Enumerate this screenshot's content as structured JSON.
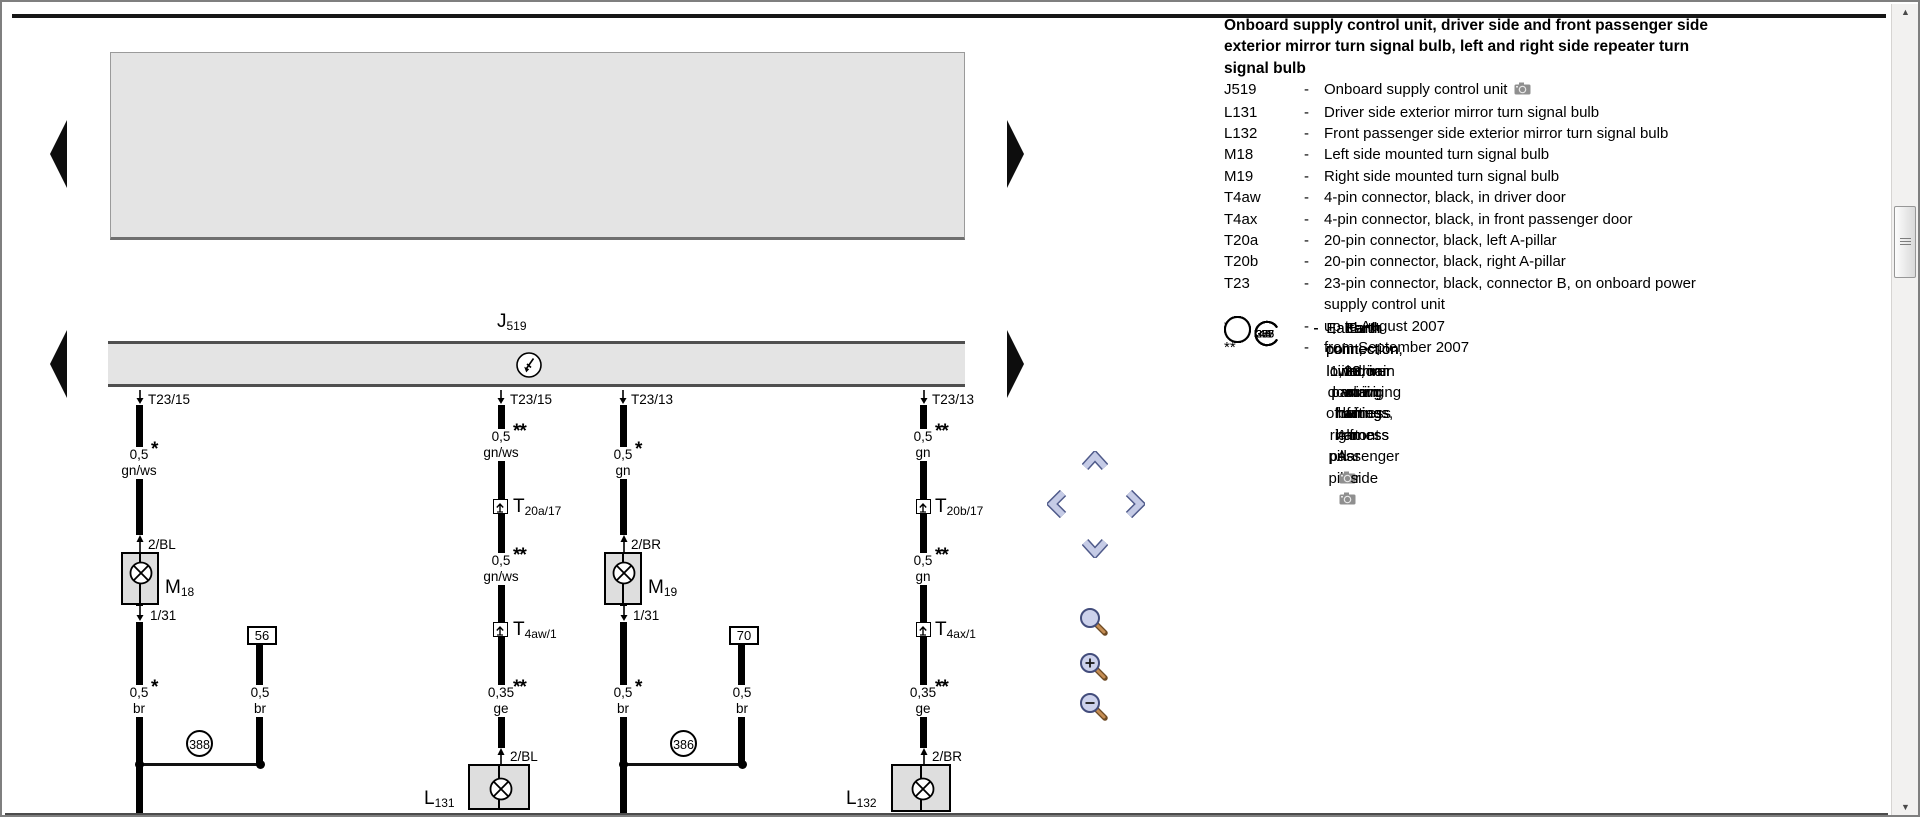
{
  "legend": {
    "title_lines": [
      "Onboard supply control unit, driver side and front passenger side",
      "exterior mirror turn signal bulb, left and right side repeater turn",
      "signal bulb"
    ],
    "entries": [
      {
        "code": "J519",
        "type": "text",
        "desc": "Onboard supply control unit",
        "camera": true
      },
      {
        "code": "L131",
        "type": "text",
        "desc": "Driver side exterior mirror turn signal bulb"
      },
      {
        "code": "L132",
        "type": "text",
        "desc": "Front passenger side exterior mirror turn signal bulb"
      },
      {
        "code": "M18",
        "type": "text",
        "desc": "Left side mounted turn signal bulb"
      },
      {
        "code": "M19",
        "type": "text",
        "desc": "Right side mounted turn signal bulb"
      },
      {
        "code": "T4aw",
        "type": "text",
        "desc": "4-pin connector, black, in driver door"
      },
      {
        "code": "T4ax",
        "type": "text",
        "desc": "4-pin connector, black, in front passenger door"
      },
      {
        "code": "T20a",
        "type": "text",
        "desc": "20-pin connector, black, left A-pillar"
      },
      {
        "code": "T20b",
        "type": "text",
        "desc": "20-pin connector, black, right A-pillar"
      },
      {
        "code": "T23",
        "type": "text",
        "desc": [
          "23-pin connector, black, connector B, on onboard power",
          "supply control unit"
        ]
      },
      {
        "code": "43",
        "type": "earth",
        "desc": "Earth point, lower part of right A-pillar",
        "camera": true
      },
      {
        "code": "44",
        "type": "earth",
        "desc": "Earth point, lower part of left A-pillar",
        "camera": true
      },
      {
        "code": "205",
        "type": "earth",
        "desc": "Earth connection, in driver door wiring harness"
      },
      {
        "code": "206",
        "type": "earth",
        "desc": "Earth connection, in door wiring harness, front passenger side"
      },
      {
        "code": "366",
        "type": "earth",
        "desc": "Earth connection 1, in main wiring harness"
      },
      {
        "code": "375",
        "type": "earth",
        "desc": "Earth connection 10, in main wiring harness"
      },
      {
        "code": "387",
        "type": "earth",
        "desc": "Earth connection 22, in main wiring harness"
      },
      {
        "code": "388",
        "type": "earth",
        "desc": "Earth connection 23, in main wiring harness"
      },
      {
        "code": "*",
        "type": "note",
        "desc": "up to August 2007"
      },
      {
        "code": "**",
        "type": "note",
        "desc": "from September 2007"
      }
    ]
  },
  "diagram": {
    "unit": {
      "main": "J",
      "sub": "519"
    },
    "pins": {
      "p1": "T23/15",
      "p2": "T23/15",
      "p3": "T23/13",
      "p4": "T23/13"
    },
    "col1": {
      "seg1": {
        "size": "0,5",
        "stars": "*",
        "color": "gn/ws"
      },
      "branch": "2/BL",
      "lamp": {
        "main": "M",
        "sub": "18"
      },
      "pin3": "1/31",
      "seg2": {
        "size": "0,5",
        "stars": "*",
        "color": "br"
      }
    },
    "col1b": {
      "terminal": "56",
      "seg": {
        "size": "0,5",
        "color": "br"
      }
    },
    "earth_left": "388",
    "col2": {
      "seg1": {
        "size": "0,5",
        "stars": "**",
        "color": "gn/ws"
      },
      "conn1": {
        "main": "T",
        "sub": "20a/17"
      },
      "seg2": {
        "size": "0,5",
        "stars": "**",
        "color": "gn/ws"
      },
      "conn2": {
        "main": "T",
        "sub": "4aw/1"
      },
      "seg3": {
        "size": "0,35",
        "stars": "**",
        "color": "ge"
      },
      "branch": "2/BL",
      "lamp": {
        "main": "L",
        "sub": "131"
      }
    },
    "col3": {
      "seg1": {
        "size": "0,5",
        "stars": "*",
        "color": "gn"
      },
      "branch": "2/BR",
      "lamp": {
        "main": "M",
        "sub": "19"
      },
      "pin3": "1/31",
      "seg2": {
        "size": "0,5",
        "stars": "*",
        "color": "br"
      }
    },
    "col3b": {
      "terminal": "70",
      "seg": {
        "size": "0,5",
        "color": "br"
      }
    },
    "earth_right": "386",
    "col4": {
      "seg1": {
        "size": "0,5",
        "stars": "**",
        "color": "gn"
      },
      "conn1": {
        "main": "T",
        "sub": "20b/17"
      },
      "seg2": {
        "size": "0,5",
        "stars": "**",
        "color": "gn"
      },
      "conn2": {
        "main": "T",
        "sub": "4ax/1"
      },
      "seg3": {
        "size": "0,35",
        "stars": "**",
        "color": "ge"
      },
      "branch": "2/BR",
      "lamp": {
        "main": "L",
        "sub": "132"
      }
    }
  },
  "nav": {
    "icons": [
      "scroll-up",
      "scroll-left",
      "scroll-right",
      "scroll-down",
      "zoom-tool",
      "zoom-in",
      "zoom-out"
    ]
  },
  "colors": {
    "diagram_gray": "#e4e4e4",
    "chevron_fill": "#c5cbe6",
    "chevron_border": "#4f5a8a",
    "magnifier_lens": "#cdd2ec",
    "magnifier_handle": "#c58d53",
    "camera_gray": "#8f8f8f"
  }
}
